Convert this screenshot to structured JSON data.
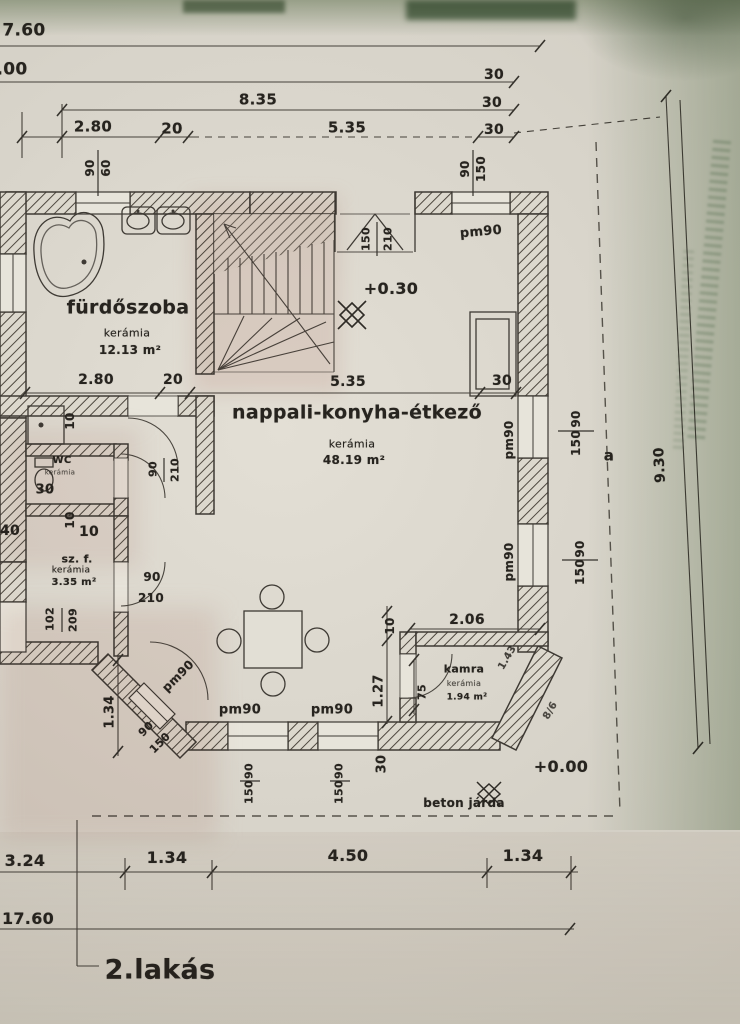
{
  "plan": {
    "title": "2.lakás",
    "rooms": [
      {
        "name": "fürdőszoba",
        "material": "kerámia",
        "area": "12.13 m²"
      },
      {
        "name": "nappali-konyha-étkező",
        "material": "kerámia",
        "area": "48.19 m²"
      },
      {
        "name": "WC",
        "material": "kerámia",
        "area": ""
      },
      {
        "name": "sz. f.",
        "material": "kerámia",
        "area": "3.35 m²"
      },
      {
        "name": "kamra",
        "material": "kerámia",
        "area": "1.94 m²"
      }
    ],
    "levels": [
      "+0.30",
      "+0.00"
    ],
    "notes": [
      "beton járda"
    ],
    "overall_dimensions": {
      "width": "17.60",
      "height": "9.30"
    }
  },
  "colors": {
    "paper": "#d8d4ca",
    "ink": "#27241f",
    "tint_green": "#8fa789",
    "tint_pink": "#d1a096"
  },
  "labels": [
    {
      "name": "dim-top-7-60",
      "text": "7.60",
      "x": 24,
      "y": 31,
      "rot": 0,
      "size": 17,
      "weight": 700
    },
    {
      "name": "dim-top-00",
      "text": ".00",
      "x": 12,
      "y": 70,
      "rot": 0,
      "size": 17,
      "weight": 700
    },
    {
      "name": "dim-top-8-35",
      "text": "8.35",
      "x": 258,
      "y": 100,
      "rot": 0,
      "size": 15,
      "weight": 700
    },
    {
      "name": "dim-top-2-80",
      "text": "2.80",
      "x": 93,
      "y": 127,
      "rot": 0,
      "size": 15,
      "weight": 700
    },
    {
      "name": "dim-top-20",
      "text": "20",
      "x": 172,
      "y": 129,
      "rot": 0,
      "size": 15,
      "weight": 700
    },
    {
      "name": "dim-top-5-35",
      "text": "5.35",
      "x": 347,
      "y": 128,
      "rot": 0,
      "size": 15,
      "weight": 700
    },
    {
      "name": "dim-top-30-a",
      "text": "30",
      "x": 494,
      "y": 75,
      "rot": 0,
      "size": 14,
      "weight": 700
    },
    {
      "name": "dim-top-30-b",
      "text": "30",
      "x": 492,
      "y": 103,
      "rot": 0,
      "size": 14,
      "weight": 700
    },
    {
      "name": "dim-top-30-c",
      "text": "30",
      "x": 494,
      "y": 130,
      "rot": 0,
      "size": 14,
      "weight": 700
    },
    {
      "name": "win-bath-w",
      "text": "90",
      "x": 90,
      "y": 168,
      "rot": -90,
      "size": 12,
      "weight": 700
    },
    {
      "name": "win-bath-h",
      "text": "60",
      "x": 106,
      "y": 168,
      "rot": -90,
      "size": 12,
      "weight": 700
    },
    {
      "name": "win-topright-w",
      "text": "90",
      "x": 465,
      "y": 169,
      "rot": -90,
      "size": 12,
      "weight": 700
    },
    {
      "name": "win-topright-h",
      "text": "150",
      "x": 481,
      "y": 169,
      "rot": -90,
      "size": 12,
      "weight": 700
    },
    {
      "name": "door-entry-w",
      "text": "150",
      "x": 366,
      "y": 239,
      "rot": -90,
      "size": 11,
      "weight": 700
    },
    {
      "name": "door-entry-h",
      "text": "210",
      "x": 388,
      "y": 239,
      "rot": -90,
      "size": 11,
      "weight": 700
    },
    {
      "name": "sill-entry",
      "text": "pm90",
      "x": 481,
      "y": 232,
      "rot": -5,
      "size": 13,
      "weight": 700
    },
    {
      "name": "level-upper",
      "text": "+0.30",
      "x": 391,
      "y": 289,
      "rot": 0,
      "size": 16,
      "weight": 800
    },
    {
      "name": "room-living-name",
      "text": "nappali-konyha-étkező",
      "x": 357,
      "y": 413,
      "rot": 0,
      "size": 19,
      "weight": 800
    },
    {
      "name": "room-living-material",
      "text": "kerámia",
      "x": 352,
      "y": 444,
      "rot": 0,
      "size": 11,
      "weight": 400
    },
    {
      "name": "room-living-area",
      "text": "48.19 m²",
      "x": 354,
      "y": 460,
      "rot": 0,
      "size": 12,
      "weight": 700
    },
    {
      "name": "room-bath-name",
      "text": "fürdőszoba",
      "x": 128,
      "y": 308,
      "rot": 0,
      "size": 19,
      "weight": 800
    },
    {
      "name": "room-bath-material",
      "text": "kerámia",
      "x": 127,
      "y": 333,
      "rot": 0,
      "size": 11,
      "weight": 400
    },
    {
      "name": "room-bath-area",
      "text": "12.13 m²",
      "x": 130,
      "y": 350,
      "rot": 0,
      "size": 12,
      "weight": 700
    },
    {
      "name": "dim-int-2-80",
      "text": "2.80",
      "x": 96,
      "y": 380,
      "rot": 0,
      "size": 14,
      "weight": 700
    },
    {
      "name": "dim-int-20",
      "text": "20",
      "x": 173,
      "y": 380,
      "rot": 0,
      "size": 14,
      "weight": 700
    },
    {
      "name": "dim-int-5-35",
      "text": "5.35",
      "x": 348,
      "y": 382,
      "rot": 0,
      "size": 14,
      "weight": 700
    },
    {
      "name": "dim-int-30",
      "text": "30",
      "x": 502,
      "y": 381,
      "rot": 0,
      "size": 14,
      "weight": 700
    },
    {
      "name": "sill-right-upper",
      "text": "pm90",
      "x": 509,
      "y": 440,
      "rot": -90,
      "size": 12,
      "weight": 700
    },
    {
      "name": "win-right-upper-w",
      "text": "90",
      "x": 576,
      "y": 419,
      "rot": -90,
      "size": 12,
      "weight": 700
    },
    {
      "name": "win-right-upper-h",
      "text": "150",
      "x": 576,
      "y": 443,
      "rot": -90,
      "size": 12,
      "weight": 700
    },
    {
      "name": "section-a",
      "text": "a",
      "x": 609,
      "y": 456,
      "rot": 0,
      "size": 15,
      "weight": 700
    },
    {
      "name": "sill-right-lower",
      "text": "pm90",
      "x": 509,
      "y": 562,
      "rot": -90,
      "size": 12,
      "weight": 700
    },
    {
      "name": "win-right-lower-w",
      "text": "90",
      "x": 580,
      "y": 549,
      "rot": -90,
      "size": 12,
      "weight": 700
    },
    {
      "name": "win-right-lower-h",
      "text": "150",
      "x": 580,
      "y": 572,
      "rot": -90,
      "size": 12,
      "weight": 700
    },
    {
      "name": "dim-right-9-30",
      "text": "9.30",
      "x": 660,
      "y": 465,
      "rot": -93,
      "size": 14,
      "weight": 700
    },
    {
      "name": "dim-10-a",
      "text": "10",
      "x": 70,
      "y": 421,
      "rot": -90,
      "size": 12,
      "weight": 700
    },
    {
      "name": "room-wc-name",
      "text": "WC",
      "x": 62,
      "y": 461,
      "rot": 0,
      "size": 10,
      "weight": 700
    },
    {
      "name": "room-wc-material",
      "text": "kerámia",
      "x": 60,
      "y": 473,
      "rot": 0,
      "size": 7,
      "weight": 400,
      "op": 0.75
    },
    {
      "name": "dim-wc-30",
      "text": "30",
      "x": 45,
      "y": 490,
      "rot": 0,
      "size": 13,
      "weight": 700
    },
    {
      "name": "door-wc-w",
      "text": "90",
      "x": 153,
      "y": 469,
      "rot": -90,
      "size": 11,
      "weight": 700
    },
    {
      "name": "door-wc-h",
      "text": "210",
      "x": 175,
      "y": 470,
      "rot": -90,
      "size": 11,
      "weight": 700
    },
    {
      "name": "dim-10-b",
      "text": "10",
      "x": 70,
      "y": 520,
      "rot": -90,
      "size": 12,
      "weight": 700
    },
    {
      "name": "dim-10-c",
      "text": "10",
      "x": 89,
      "y": 532,
      "rot": 0,
      "size": 14,
      "weight": 700
    },
    {
      "name": "room-szf-name",
      "text": "sz. f.",
      "x": 77,
      "y": 559,
      "rot": 0,
      "size": 11,
      "weight": 700
    },
    {
      "name": "room-szf-material",
      "text": "kerámia",
      "x": 71,
      "y": 571,
      "rot": 0,
      "size": 9,
      "weight": 400
    },
    {
      "name": "room-szf-area",
      "text": "3.35 m²",
      "x": 74,
      "y": 583,
      "rot": 0,
      "size": 10,
      "weight": 700
    },
    {
      "name": "door-szf-w",
      "text": "90",
      "x": 152,
      "y": 577,
      "rot": 0,
      "size": 12,
      "weight": 700
    },
    {
      "name": "door-szf-h",
      "text": "210",
      "x": 151,
      "y": 598,
      "rot": 0,
      "size": 12,
      "weight": 700
    },
    {
      "name": "dim-left-40",
      "text": "40",
      "x": 10,
      "y": 531,
      "rot": 0,
      "size": 14,
      "weight": 700
    },
    {
      "name": "door-left-w",
      "text": "102",
      "x": 50,
      "y": 619,
      "rot": -90,
      "size": 11,
      "weight": 700
    },
    {
      "name": "door-left-h",
      "text": "209",
      "x": 73,
      "y": 620,
      "rot": -90,
      "size": 11,
      "weight": 700
    },
    {
      "name": "dim-1-34-left",
      "text": "1.34",
      "x": 110,
      "y": 712,
      "rot": -90,
      "size": 13,
      "weight": 700
    },
    {
      "name": "sill-diag",
      "text": "pm90",
      "x": 178,
      "y": 676,
      "rot": -45,
      "size": 12,
      "weight": 700
    },
    {
      "name": "win-diag-w",
      "text": "90",
      "x": 146,
      "y": 729,
      "rot": -45,
      "size": 11,
      "weight": 700
    },
    {
      "name": "win-diag-h",
      "text": "150",
      "x": 160,
      "y": 743,
      "rot": -45,
      "size": 11,
      "weight": 700
    },
    {
      "name": "sill-bottom-a",
      "text": "pm90",
      "x": 240,
      "y": 710,
      "rot": 0,
      "size": 13,
      "weight": 700
    },
    {
      "name": "sill-bottom-b",
      "text": "pm90",
      "x": 332,
      "y": 710,
      "rot": 0,
      "size": 13,
      "weight": 700
    },
    {
      "name": "dim-kamra-10",
      "text": "10",
      "x": 390,
      "y": 626,
      "rot": -90,
      "size": 12,
      "weight": 700
    },
    {
      "name": "dim-1-27",
      "text": "1.27",
      "x": 379,
      "y": 691,
      "rot": -90,
      "size": 13,
      "weight": 700
    },
    {
      "name": "dim-2-06",
      "text": "2.06",
      "x": 467,
      "y": 620,
      "rot": 0,
      "size": 14,
      "weight": 700
    },
    {
      "name": "dim-75",
      "text": "75",
      "x": 422,
      "y": 692,
      "rot": -90,
      "size": 11,
      "weight": 700
    },
    {
      "name": "room-kamra-name",
      "text": "kamra",
      "x": 464,
      "y": 669,
      "rot": 0,
      "size": 11,
      "weight": 800
    },
    {
      "name": "room-kamra-material",
      "text": "kerámia",
      "x": 464,
      "y": 684,
      "rot": 0,
      "size": 8,
      "weight": 400,
      "op": 0.8
    },
    {
      "name": "room-kamra-area",
      "text": "1.94 m²",
      "x": 467,
      "y": 698,
      "rot": 0,
      "size": 9,
      "weight": 700
    },
    {
      "name": "dim-kamra-diag",
      "text": "1.43",
      "x": 508,
      "y": 658,
      "rot": -60,
      "size": 10,
      "weight": 700,
      "op": 0.85
    },
    {
      "name": "dim-chamfer",
      "text": "8/6",
      "x": 551,
      "y": 711,
      "rot": -60,
      "size": 10,
      "weight": 700,
      "op": 0.8
    },
    {
      "name": "dim-bottom-30",
      "text": "30",
      "x": 382,
      "y": 764,
      "rot": -90,
      "size": 13,
      "weight": 700
    },
    {
      "name": "win-bottom-a-w",
      "text": "90",
      "x": 249,
      "y": 771,
      "rot": -90,
      "size": 11,
      "weight": 700
    },
    {
      "name": "win-bottom-a-h",
      "text": "150",
      "x": 249,
      "y": 792,
      "rot": -90,
      "size": 11,
      "weight": 700
    },
    {
      "name": "win-bottom-b-w",
      "text": "90",
      "x": 339,
      "y": 771,
      "rot": -90,
      "size": 11,
      "weight": 700
    },
    {
      "name": "win-bottom-b-h",
      "text": "150",
      "x": 339,
      "y": 792,
      "rot": -90,
      "size": 11,
      "weight": 700
    },
    {
      "name": "level-ground",
      "text": "+0.00",
      "x": 561,
      "y": 767,
      "rot": 0,
      "size": 16,
      "weight": 800
    },
    {
      "name": "walkway-label",
      "text": "beton járda",
      "x": 464,
      "y": 803,
      "rot": 0,
      "size": 12,
      "weight": 700
    },
    {
      "name": "dim-b-3-24",
      "text": "3.24",
      "x": 25,
      "y": 861,
      "rot": 0,
      "size": 16,
      "weight": 700
    },
    {
      "name": "dim-b-1-34-l",
      "text": "1.34",
      "x": 167,
      "y": 858,
      "rot": 0,
      "size": 16,
      "weight": 700
    },
    {
      "name": "dim-b-4-50",
      "text": "4.50",
      "x": 348,
      "y": 856,
      "rot": 0,
      "size": 16,
      "weight": 700
    },
    {
      "name": "dim-b-1-34-r",
      "text": "1.34",
      "x": 523,
      "y": 856,
      "rot": 0,
      "size": 16,
      "weight": 700
    },
    {
      "name": "dim-b-17-60",
      "text": "17.60",
      "x": 28,
      "y": 919,
      "rot": 0,
      "size": 16,
      "weight": 700
    },
    {
      "name": "plan-title",
      "text": "2.lakás",
      "x": 160,
      "y": 970,
      "rot": 0,
      "size": 27,
      "weight": 800
    }
  ]
}
